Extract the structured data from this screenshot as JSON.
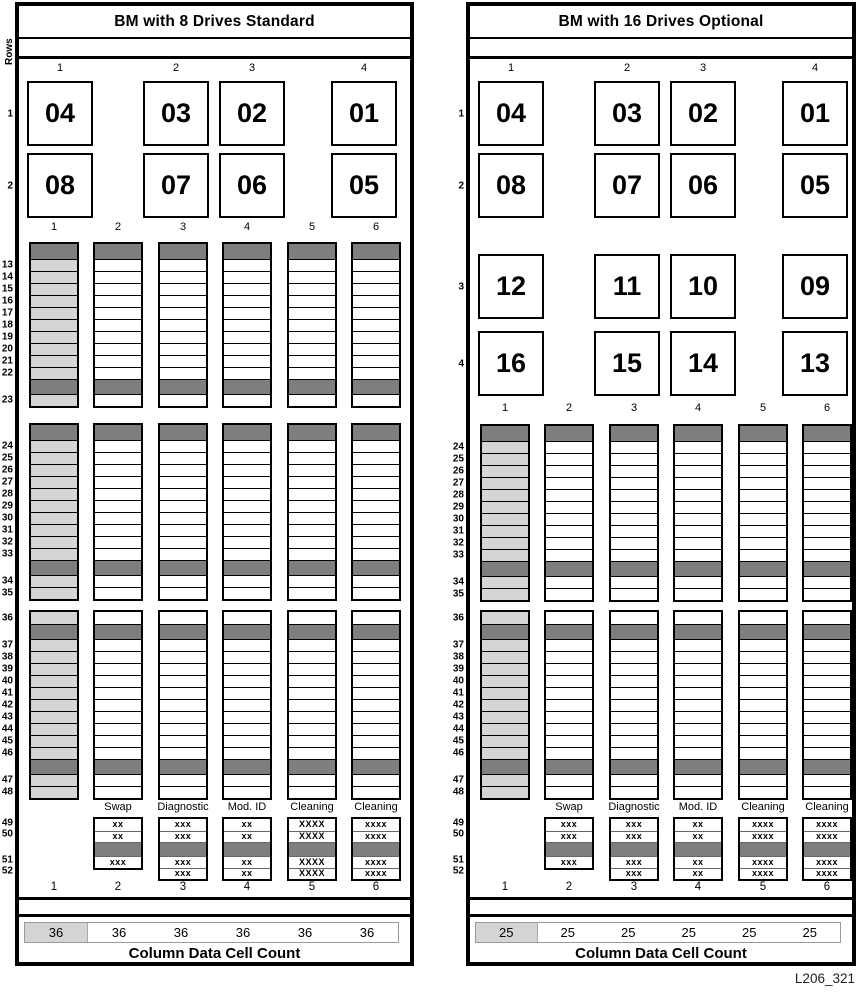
{
  "figure_label": "L206_321",
  "colors": {
    "dark_cell": "#7e7e7e",
    "shaded_cell": "#d5d5d5",
    "border": "#000000"
  },
  "shared": {
    "rows_axis_label": "Rows",
    "drive_column_headers": [
      "1",
      "2",
      "3",
      "4"
    ],
    "cell_column_headers": [
      "1",
      "2",
      "3",
      "4",
      "5",
      "6"
    ],
    "bottom_column_numbers": [
      "1",
      "2",
      "3",
      "4",
      "5",
      "6"
    ],
    "count_label": "Column Data Cell Count"
  },
  "panels": [
    {
      "id": "bm-8-drives",
      "title": "BM with 8 Drives Standard",
      "show_rows_axis": true,
      "drive_rows": [
        {
          "label": "1",
          "drives": [
            "04",
            "03",
            "02",
            "01"
          ]
        },
        {
          "label": "2",
          "drives": [
            "08",
            "07",
            "06",
            "05"
          ]
        }
      ],
      "cell_blocks": [
        [
          "dark",
          "13",
          "14",
          "15",
          "16",
          "17",
          "18",
          "19",
          "20",
          "21",
          "22",
          "dark",
          "23"
        ],
        [
          "dark",
          "24",
          "25",
          "26",
          "27",
          "28",
          "29",
          "30",
          "31",
          "32",
          "33",
          "dark",
          "34",
          "35"
        ],
        [
          "36",
          "dark",
          "37",
          "38",
          "39",
          "40",
          "41",
          "42",
          "43",
          "44",
          "45",
          "46",
          "dark",
          "47",
          "48"
        ]
      ],
      "special_row_labels": [
        "49",
        "50",
        "",
        "51",
        "52"
      ],
      "special_columns": [
        {
          "header": "",
          "cells": []
        },
        {
          "header": "Swap",
          "cells": [
            "xx",
            "xx",
            "dark",
            "xxx"
          ]
        },
        {
          "header": "Diagnostic",
          "cells": [
            "xxx",
            "xxx",
            "dark",
            "xxx",
            "xxx"
          ]
        },
        {
          "header": "Mod. ID",
          "cells": [
            "xx",
            "xx",
            "dark",
            "xx",
            "xx"
          ]
        },
        {
          "header": "Cleaning",
          "cells": [
            "XXXX",
            "XXXX",
            "dark",
            "XXXX",
            "XXXX"
          ]
        },
        {
          "header": "Cleaning",
          "cells": [
            "xxxx",
            "xxxx",
            "dark",
            "xxxx",
            "xxxx"
          ]
        }
      ],
      "count_values": [
        "36",
        "36",
        "36",
        "36",
        "36",
        "36"
      ]
    },
    {
      "id": "bm-16-drives",
      "title": "BM with 16 Drives Optional",
      "show_rows_axis": false,
      "drive_rows": [
        {
          "label": "1",
          "drives": [
            "04",
            "03",
            "02",
            "01"
          ]
        },
        {
          "label": "2",
          "drives": [
            "08",
            "07",
            "06",
            "05"
          ]
        },
        {
          "label": "3",
          "drives": [
            "12",
            "11",
            "10",
            "09"
          ]
        },
        {
          "label": "4",
          "drives": [
            "16",
            "15",
            "14",
            "13"
          ]
        }
      ],
      "cell_blocks": [
        [
          "dark",
          "24",
          "25",
          "26",
          "27",
          "28",
          "29",
          "30",
          "31",
          "32",
          "33",
          "dark",
          "34",
          "35"
        ],
        [
          "36",
          "dark",
          "37",
          "38",
          "39",
          "40",
          "41",
          "42",
          "43",
          "44",
          "45",
          "46",
          "dark",
          "47",
          "48"
        ]
      ],
      "special_row_labels": [
        "49",
        "50",
        "",
        "51",
        "52"
      ],
      "special_columns": [
        {
          "header": "",
          "cells": []
        },
        {
          "header": "Swap",
          "cells": [
            "xxx",
            "xxx",
            "dark",
            "xxx"
          ]
        },
        {
          "header": "Diagnostic",
          "cells": [
            "xxx",
            "xxx",
            "dark",
            "xxx",
            "xxx"
          ]
        },
        {
          "header": "Mod. ID",
          "cells": [
            "xx",
            "xx",
            "dark",
            "xx",
            "xx"
          ]
        },
        {
          "header": "Cleaning",
          "cells": [
            "xxxx",
            "xxxx",
            "dark",
            "xxxx",
            "xxxx"
          ]
        },
        {
          "header": "Cleaning",
          "cells": [
            "xxxx",
            "xxxx",
            "dark",
            "xxxx",
            "xxxx"
          ]
        }
      ],
      "count_values": [
        "25",
        "25",
        "25",
        "25",
        "25",
        "25"
      ]
    }
  ]
}
